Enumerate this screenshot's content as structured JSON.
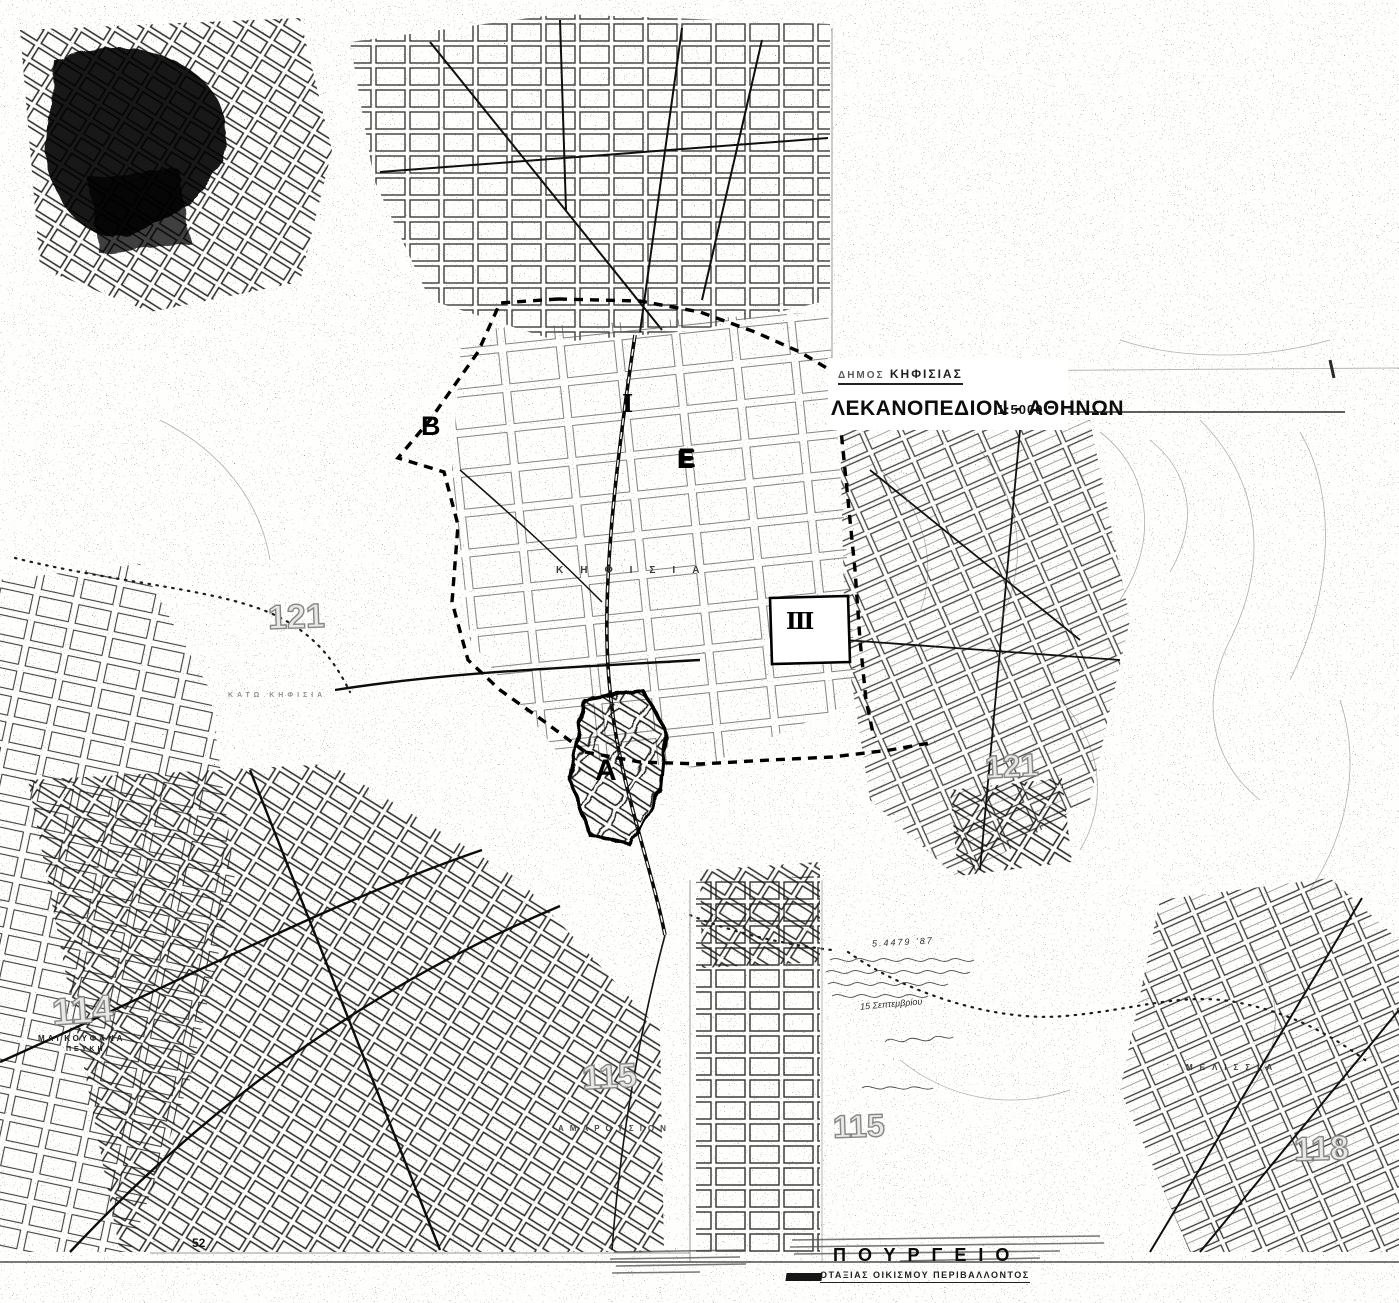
{
  "colors": {
    "ink": "#111111",
    "paper": "#fefefc",
    "hollow_number_stroke": "#868686"
  },
  "header": {
    "municipality": "ΔΗΜΟΣ",
    "municipality2": "ΚΗΦΙΣΙΑΣ",
    "title": "ΛΕΚΑΝΟΠΕΔΙΟΝ - ΑΘΗΝΩΝ",
    "scale": "1:5000"
  },
  "sheet_numbers": {
    "left_121": "121",
    "right_121": "121",
    "n114": "114",
    "s115_a": "115",
    "s115_b": "115",
    "s118": "118"
  },
  "road_number": "52",
  "zone_markers": {
    "a": "Α",
    "b": "Β",
    "e": "Ε",
    "i": "Ι",
    "iii": "ΙΙΙ"
  },
  "place_names": {
    "magkoufana": "ΜΑΓΚΟΥΦΑΝΑ",
    "pefki": "ΠΕΥΚΗ",
    "kifisia": "ΚΗΦΙΣΙΑ",
    "kato_kifisia": "ΚΑΤΩ ΚΗΦΙΣΙΑ",
    "amarousion": "ΑΜΑΡΟΥΣΙΟΝ",
    "melissia": "ΜΕΛΙΣΣΙΑ"
  },
  "footer": {
    "ministry_line1": "ΠΟΥΡΓΕΙΟ",
    "ministry_line2": "ΟΤΑΞΙΑΣ  ΟΙΚΙΣΜΟΥ  ΠΕΡΙΒΑΛΛΟΝΤΟΣ"
  },
  "annotation": {
    "ref": "5.4479 '87",
    "date": "15 Σεπτεμβρίου"
  }
}
